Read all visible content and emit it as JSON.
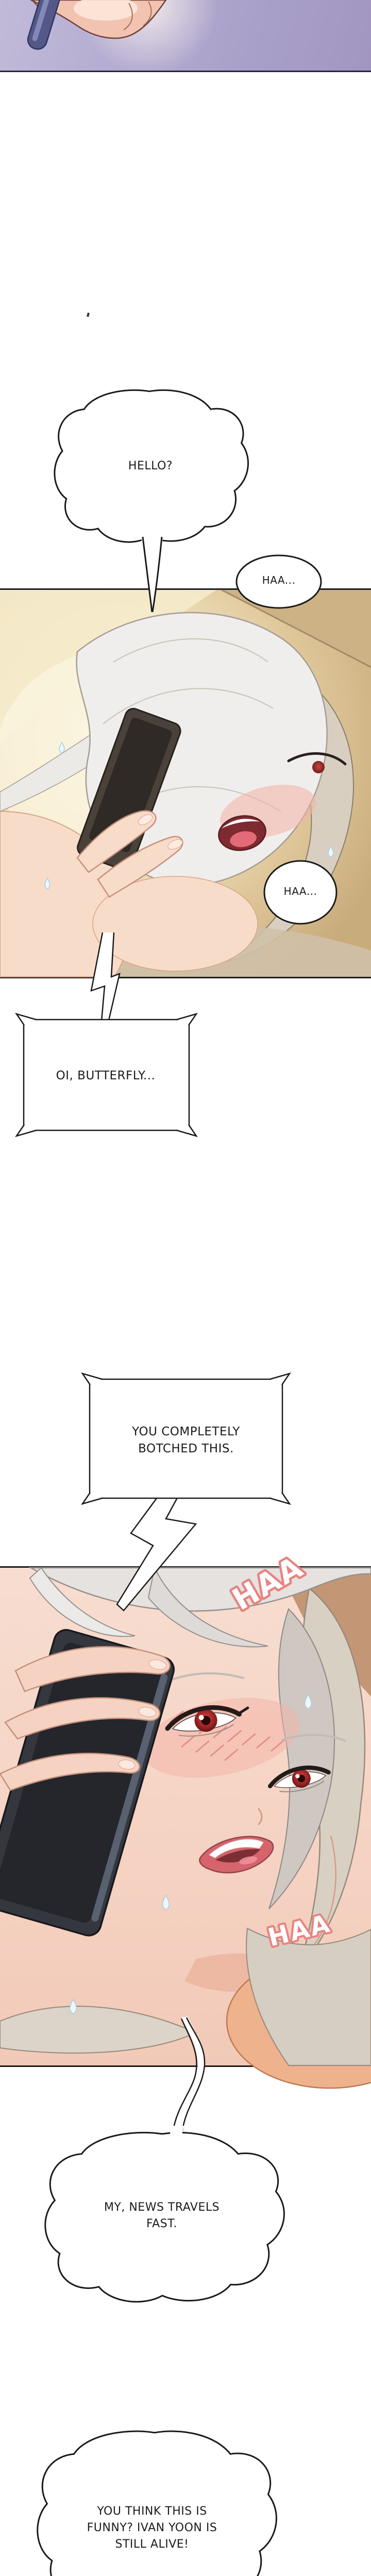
{
  "page": {
    "title": "webtoon-episode-strip",
    "background": "#ffffff"
  },
  "colors": {
    "outline": "#1a1a1a",
    "top_panel_bg": "#b0a8cc",
    "top_panel_border": "#2a2342",
    "panel_b_glow": "#faf3dd",
    "panel_c_skin": "#f5d4c4",
    "sfx_fill": "#ffffff",
    "sfx_stroke": "#e8837f"
  },
  "speech": {
    "hello": "HELLO?",
    "haa_breath_1": "HAA...",
    "haa_breath_2": "HAA...",
    "oi_butterfly": "OI, BUTTERFLY...",
    "botched_l1": "YOU COMPLETELY",
    "botched_l2": "BOTCHED THIS.",
    "news_l1": "MY, NEWS TRAVELS",
    "news_l2": "FAST.",
    "alive_l1": "YOU THINK THIS IS",
    "alive_l2": "FUNNY? IVAN YOON IS",
    "alive_l3": "STILL ALIVE!"
  },
  "sfx": {
    "haa_gasp_upper": "HAA",
    "haa_gasp_lower": "HAA"
  }
}
